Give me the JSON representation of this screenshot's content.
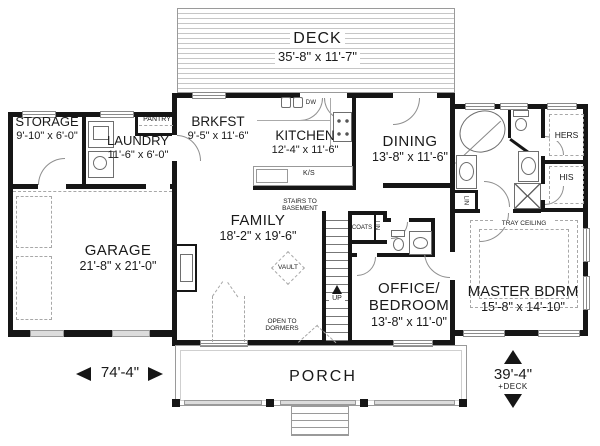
{
  "rooms": {
    "deck": {
      "name": "DECK",
      "dims": "35'-8\" x 11'-7\""
    },
    "storage": {
      "name": "STORAGE",
      "dims": "9'-10\" x 6'-0\""
    },
    "laundry": {
      "name": "LAUNDRY",
      "dims": "11'-6\" x 6'-0\""
    },
    "brkfst": {
      "name": "BRKFST",
      "dims": "9'-5\" x 11'-6\""
    },
    "kitchen": {
      "name": "KITCHEN",
      "dims": "12'-4\" x 11'-6\""
    },
    "dining": {
      "name": "DINING",
      "dims": "13'-8\" x 11'-6\""
    },
    "family": {
      "name": "FAMILY",
      "dims": "18'-2\" x 19'-6\""
    },
    "garage": {
      "name": "GARAGE",
      "dims": "21'-8\" x 21'-0\""
    },
    "office": {
      "name_line1": "OFFICE/",
      "name_line2": "BEDROOM",
      "dims": "13'-8\" x 11'-0\""
    },
    "master": {
      "name": "MASTER BDRM",
      "dims": "15'-8\" x 14'-10\""
    },
    "porch": {
      "name": "PORCH"
    }
  },
  "labels": {
    "pantry": "PANTRY",
    "hers": "HERS",
    "his": "HIS",
    "lin_bath": "LIN",
    "lin_hall": "LIN",
    "coats": "COATS",
    "kitchen_sink": "K/S",
    "dishwasher": "DW",
    "vault": "VAULT",
    "up": "UP",
    "stairs_note_line1": "STAIRS TO",
    "stairs_note_line2": "BASEMENT",
    "dormer_note_line1": "OPEN TO",
    "dormer_note_line2": "DORMERS",
    "tray_ceiling": "TRAY CEILING"
  },
  "dimensions": {
    "overall_width": "74'-4\"",
    "overall_depth": "39'-4\"",
    "overall_depth_note": "+DECK"
  },
  "colors": {
    "wall": "#161616",
    "line": "#8a8a8a",
    "background": "#ffffff"
  }
}
